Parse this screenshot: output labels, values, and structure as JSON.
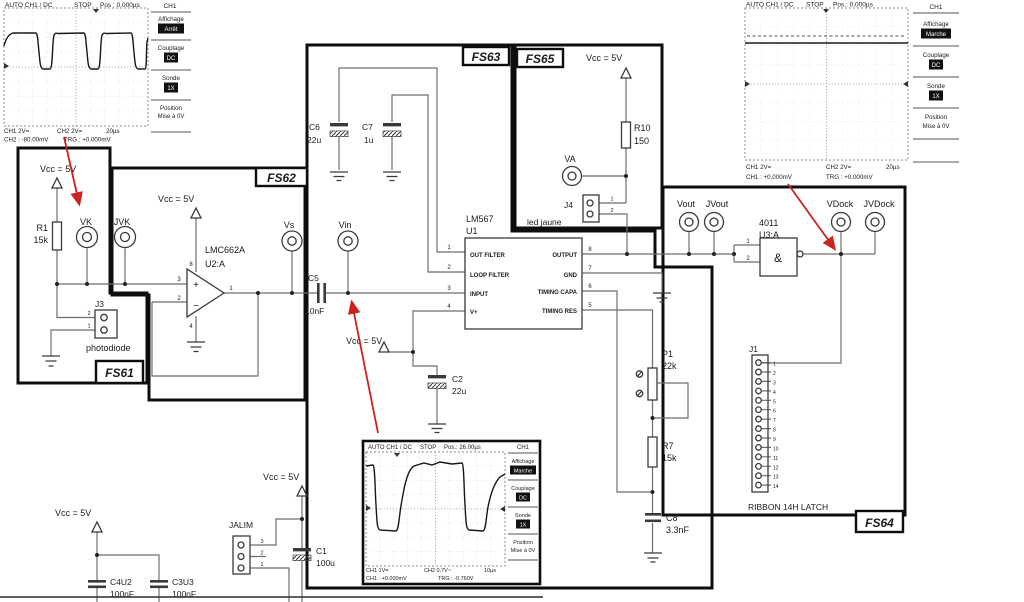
{
  "colors": {
    "arrow": "#cc2222",
    "block_border": "#0d0d0d",
    "wire": "#6e6e6e"
  },
  "scope1": {
    "title": "AUTO CH1 / DC",
    "status": "STOP",
    "pos": "Pos : 0.000µs",
    "ch": "CH1",
    "menu": [
      {
        "label": "Affichage",
        "value": "Arrêt"
      },
      {
        "label": "Couplage",
        "value": "DC"
      },
      {
        "label": "Sonde",
        "value": "1X"
      },
      {
        "label": "Position",
        "value": "Mise à 0V"
      }
    ],
    "b1": "CH1 2V=",
    "b2": "CH2 2V=",
    "b3": "20µs",
    "b4": "CH2 : -80.00mV",
    "b5": "TRG : +0.000mV"
  },
  "scope2": {
    "title": "AUTO CH1 / DC",
    "status": "STOP",
    "pos": "Pos.: 0.000µs",
    "ch": "CH1",
    "menu": [
      {
        "label": "Affichage",
        "value": "Marche"
      },
      {
        "label": "Couplage",
        "value": "DC"
      },
      {
        "label": "Sonde",
        "value": "1X"
      },
      {
        "label": "Position",
        "value": "Mise à 0V"
      }
    ],
    "b1": "CH1 2V=",
    "b2": "CH2 2V=",
    "b3": "20µs",
    "b4": "CH1 : +0.000mV",
    "b5": "TRG : +0.000mV"
  },
  "scope3": {
    "title": "AUTO CH1 / DC",
    "status": "STOP",
    "pos": "Pos.: 26.00µs",
    "ch": "CH1",
    "menu": [
      {
        "label": "Affichage",
        "value": "Marche"
      },
      {
        "label": "Couplage",
        "value": "DC"
      },
      {
        "label": "Sonde",
        "value": "1X"
      },
      {
        "label": "Position",
        "value": "Mise à 0V"
      }
    ],
    "b1": "CH1 1V=",
    "b2": "CH2 0.7V~",
    "b3": "10µs",
    "b4": "CH1 : +0.000mV",
    "b5": "TRG : -0.760V"
  },
  "sch": {
    "vcc": "Vcc = 5V",
    "fs61": "FS61",
    "fs62": "FS62",
    "fs63": "FS63",
    "fs64": "FS64",
    "fs65": "FS65",
    "r1": "R1",
    "r1_val": "15k",
    "vk": "VK",
    "jvk": "JVK",
    "vs": "Vs",
    "vin": "Vin",
    "va": "VA",
    "j3": "J3",
    "photodiode": "photodiode",
    "lmc": "LMC662A",
    "u2a": "U2:A",
    "plus": "+",
    "minus": "−",
    "c5": "C5",
    "c5_val": "10nF",
    "c6": "C6",
    "c6_val": "22u",
    "c7": "C7",
    "c7_val": "1u",
    "c2": "C2",
    "c2_val": "22u",
    "lm567": "LM567",
    "u1": "U1",
    "out_filter": "OUT FILTER",
    "loop_filter": "LOOP FILTER",
    "input": "INPUT",
    "vplus": "V+",
    "output": "OUTPUT",
    "gnd": "GND",
    "timing_capa": "TIMING CAPA",
    "timing_res": "TIMING RES",
    "r10": "R10",
    "r10_val": "150",
    "j4": "J4",
    "led_jaune": "led jaune",
    "p1": "P1",
    "p1_val": "22k",
    "r7": "R7",
    "r7_val": "15k",
    "c8": "C8",
    "c8_val": "3.3nF",
    "vout": "Vout",
    "jvout": "JVout",
    "vdock": "VDock",
    "jvdock": "JVDock",
    "g4011": "4011",
    "u3a": "U3:A",
    "and": "&",
    "j1": "J1",
    "ribbon": "RIBBON 14H LATCH",
    "jalim": "JALIM",
    "c1": "C1",
    "c1_val": "100u",
    "c4u2": "C4U2",
    "c4u2_val": "100nF",
    "c3u3": "C3U3",
    "c3u3_val": "100nF"
  },
  "num": {
    "n1": "1",
    "n2": "2",
    "n3": "3",
    "n4": "4",
    "n5": "5",
    "n6": "6",
    "n7": "7",
    "n8": "8",
    "n9": "9",
    "n10": "10",
    "n11": "11",
    "n12": "12",
    "n13": "13",
    "n14": "14"
  }
}
